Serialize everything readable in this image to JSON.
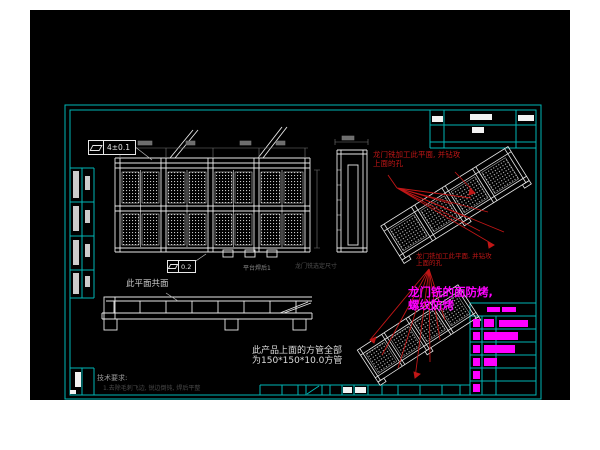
{
  "drawing": {
    "colors": {
      "page_bg": "#ffffff",
      "canvas_bg": "#000000",
      "frame_cyan": "#00b6b6",
      "line_white": "#e8e8e8",
      "annotation_red": "#c01616",
      "highlight_magenta": "#ff00ff",
      "dim_grey": "#8a8a8a"
    },
    "fcf_top": {
      "symbol": "flatness",
      "value": "4±0.1"
    },
    "fcf_mid": {
      "symbol": "flatness",
      "value": "0.2"
    },
    "labels": {
      "coplanar": "此平面共面",
      "platform": "平台焊后1",
      "gantry_dim": "龙门铣选定尺寸",
      "tech_title": "技术要求:",
      "tech_line": "1.去除毛刺飞边, 锐边倒钝, 焊后平整",
      "tube_line1": "此产品上面的方管全部",
      "tube_line2": "为150*150*10.0方管"
    },
    "red_note": {
      "line1": "龙门铣加工此平面, 并钻攻",
      "line2": "上面的孔"
    },
    "magenta_note": {
      "line1": "龙门铣的面防烤,",
      "line2": "螺纹防烤"
    }
  }
}
